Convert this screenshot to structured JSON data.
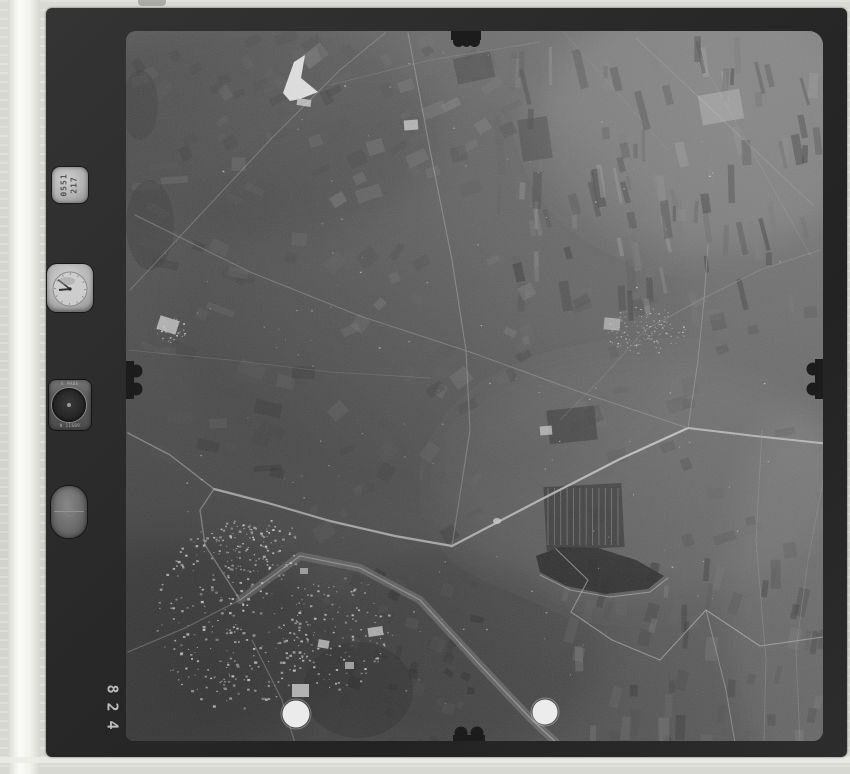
{
  "artifact": {
    "kind": "vintage aerial survey photograph, black and white film frame",
    "frame_number": "428",
    "digits_top_to_bottom": [
      "8",
      "2",
      "4"
    ]
  },
  "palette": {
    "mat": "#d6d6d0",
    "film_frame": "#2a2a2a",
    "photo_midgray": "#585858",
    "fiducial_dot": "#f2f2f2"
  },
  "instruments": {
    "id_plate": {
      "line1": "0551",
      "line2": "217"
    },
    "altimeter": {
      "label_top": "E MADE",
      "label_bottom": "N 11609"
    }
  },
  "photo": {
    "tones": [
      [
        250,
        130,
        190,
        110,
        "#000000",
        0.1
      ],
      [
        710,
        120,
        170,
        130,
        "#ffffff",
        0.1
      ],
      [
        180,
        650,
        160,
        110,
        "#000000",
        0.14
      ],
      [
        460,
        650,
        140,
        100,
        "#000000",
        0.1
      ],
      [
        800,
        600,
        70,
        190,
        "#ffffff",
        0.07
      ],
      [
        430,
        300,
        260,
        200,
        "#000000",
        0.05
      ],
      [
        640,
        480,
        200,
        120,
        "#ffffff",
        0.05
      ]
    ],
    "field_clusters": [
      {
        "seed": 11,
        "x": 490,
        "y": 36,
        "w": 325,
        "h": 264,
        "n": 110,
        "sw": [
          3,
          10
        ],
        "sh": [
          12,
          40
        ],
        "angle": -6,
        "jit": 10,
        "shade": [
          45,
          150
        ],
        "op": 0.5
      },
      {
        "seed": 22,
        "x": 300,
        "y": 36,
        "w": 200,
        "h": 170,
        "n": 40,
        "sw": [
          8,
          26
        ],
        "sh": [
          6,
          16
        ],
        "angle": -25,
        "jit": 14,
        "shade": [
          60,
          140
        ],
        "op": 0.4
      },
      {
        "seed": 33,
        "x": 128,
        "y": 150,
        "w": 172,
        "h": 320,
        "n": 45,
        "sw": [
          10,
          30
        ],
        "sh": [
          5,
          14
        ],
        "angle": 12,
        "jit": 16,
        "shade": [
          50,
          120
        ],
        "op": 0.35
      },
      {
        "seed": 44,
        "x": 300,
        "y": 240,
        "w": 260,
        "h": 300,
        "n": 55,
        "sw": [
          6,
          20
        ],
        "sh": [
          5,
          16
        ],
        "angle": -40,
        "jit": 25,
        "shade": [
          55,
          130
        ],
        "op": 0.35
      },
      {
        "seed": 55,
        "x": 560,
        "y": 555,
        "w": 260,
        "h": 183,
        "n": 60,
        "sw": [
          4,
          12
        ],
        "sh": [
          10,
          30
        ],
        "angle": 8,
        "jit": 10,
        "shade": [
          50,
          135
        ],
        "op": 0.4
      },
      {
        "seed": 66,
        "x": 560,
        "y": 300,
        "w": 260,
        "h": 260,
        "n": 40,
        "sw": [
          8,
          24
        ],
        "sh": [
          6,
          18
        ],
        "angle": -15,
        "jit": 14,
        "shade": [
          55,
          120
        ],
        "op": 0.3
      },
      {
        "seed": 77,
        "x": 300,
        "y": 560,
        "w": 180,
        "h": 180,
        "n": 50,
        "sw": [
          5,
          14
        ],
        "sh": [
          5,
          14
        ],
        "angle": 20,
        "jit": 18,
        "shade": [
          40,
          100
        ],
        "op": 0.4
      },
      {
        "seed": 88,
        "x": 128,
        "y": 36,
        "w": 172,
        "h": 114,
        "n": 30,
        "sw": [
          8,
          22
        ],
        "sh": [
          6,
          14
        ],
        "angle": -30,
        "jit": 14,
        "shade": [
          55,
          115
        ],
        "op": 0.3
      }
    ],
    "rows": [
      {
        "x": 548,
        "y": 488,
        "w": 70,
        "h": 57,
        "n": 12,
        "color": "#8f8f8f",
        "op": 0.7
      }
    ],
    "dark_patches": [
      {
        "type": "rect",
        "x": 545,
        "y": 485,
        "w": 78,
        "h": 64,
        "fill": "#3b3b3b",
        "op": 0.85,
        "rot": -3
      },
      {
        "type": "poly",
        "pts": [
          [
            536,
            556
          ],
          [
            560,
            547
          ],
          [
            598,
            548
          ],
          [
            636,
            560
          ],
          [
            664,
            576
          ],
          [
            648,
            589
          ],
          [
            606,
            594
          ],
          [
            566,
            586
          ],
          [
            540,
            572
          ]
        ],
        "fill": "#2c2c2c",
        "op": 0.92
      },
      {
        "type": "ellipse",
        "cx": 150,
        "cy": 225,
        "rx": 24,
        "ry": 45,
        "fill": "#3f3f3f",
        "op": 0.5
      },
      {
        "type": "ellipse",
        "cx": 140,
        "cy": 105,
        "rx": 18,
        "ry": 35,
        "fill": "#424242",
        "op": 0.5
      },
      {
        "type": "rect",
        "x": 548,
        "y": 408,
        "w": 48,
        "h": 34,
        "fill": "#3a3a3a",
        "op": 0.7,
        "rot": -6
      },
      {
        "type": "rect",
        "x": 455,
        "y": 55,
        "w": 38,
        "h": 26,
        "fill": "#3e3e3e",
        "op": 0.55,
        "rot": -12
      },
      {
        "type": "rect",
        "x": 520,
        "y": 118,
        "w": 30,
        "h": 42,
        "fill": "#3c3c3c",
        "op": 0.5,
        "rot": -8
      },
      {
        "type": "ellipse",
        "cx": 358,
        "cy": 690,
        "rx": 55,
        "ry": 48,
        "fill": "#383838",
        "op": 0.45
      }
    ],
    "bright_patches": [
      {
        "type": "poly",
        "pts": [
          [
            283,
            93
          ],
          [
            294,
            62
          ],
          [
            305,
            55
          ],
          [
            301,
            78
          ],
          [
            318,
            92
          ],
          [
            300,
            99
          ],
          [
            290,
            101
          ]
        ],
        "fill": "#e6e6e6",
        "op": 0.95
      },
      {
        "type": "rect",
        "x": 297,
        "y": 99,
        "w": 14,
        "h": 7,
        "fill": "#cfcfcf",
        "op": 0.8,
        "rot": 8
      },
      {
        "type": "rect",
        "x": 292,
        "y": 684,
        "w": 17,
        "h": 13,
        "fill": "#e8e8e8",
        "op": 0.9,
        "rot": 0
      },
      {
        "type": "rect",
        "x": 318,
        "y": 640,
        "w": 11,
        "h": 8,
        "fill": "#e2e2e2",
        "op": 0.85,
        "rot": 10
      },
      {
        "type": "rect",
        "x": 368,
        "y": 627,
        "w": 15,
        "h": 9,
        "fill": "#dcdcdc",
        "op": 0.85,
        "rot": -8
      },
      {
        "type": "rect",
        "x": 345,
        "y": 662,
        "w": 9,
        "h": 7,
        "fill": "#d8d8d8",
        "op": 0.8,
        "rot": 0
      },
      {
        "type": "rect",
        "x": 300,
        "y": 568,
        "w": 8,
        "h": 6,
        "fill": "#d2d2d2",
        "op": 0.8,
        "rot": 0
      },
      {
        "type": "rect",
        "x": 540,
        "y": 426,
        "w": 12,
        "h": 9,
        "fill": "#c8c8c8",
        "op": 0.8,
        "rot": -5
      },
      {
        "type": "ellipse",
        "cx": 497,
        "cy": 521,
        "rx": 4,
        "ry": 3,
        "fill": "#d8d8d8",
        "op": 0.85
      },
      {
        "type": "rect",
        "x": 158,
        "y": 318,
        "w": 20,
        "h": 14,
        "fill": "#d0d0d0",
        "op": 0.85,
        "rot": 18
      },
      {
        "type": "rect",
        "x": 404,
        "y": 120,
        "w": 14,
        "h": 10,
        "fill": "#c8c8c8",
        "op": 0.8,
        "rot": -4
      },
      {
        "type": "rect",
        "x": 700,
        "y": 92,
        "w": 42,
        "h": 30,
        "fill": "#9e9e9e",
        "op": 0.7,
        "rot": -10
      },
      {
        "type": "rect",
        "x": 604,
        "y": 318,
        "w": 16,
        "h": 12,
        "fill": "#bdbdbd",
        "op": 0.7,
        "rot": 5
      }
    ],
    "roads": [
      {
        "pts": [
          [
            214,
            489
          ],
          [
            268,
            503
          ],
          [
            330,
            521
          ],
          [
            395,
            536
          ],
          [
            452,
            546
          ]
        ],
        "w": 2.2,
        "c": "#c6c6c6",
        "op": 0.9
      },
      {
        "pts": [
          [
            452,
            546
          ],
          [
            540,
            500
          ],
          [
            620,
            459
          ],
          [
            688,
            428
          ]
        ],
        "w": 2.2,
        "c": "#c6c6c6",
        "op": 0.9
      },
      {
        "pts": [
          [
            688,
            428
          ],
          [
            755,
            436
          ],
          [
            830,
            444
          ]
        ],
        "w": 2.0,
        "c": "#c0c0c0",
        "op": 0.85
      },
      {
        "pts": [
          [
            688,
            428
          ],
          [
            698,
            360
          ],
          [
            704,
            300
          ],
          [
            708,
            245
          ]
        ],
        "w": 1.0,
        "c": "#9a9a9a",
        "op": 0.6
      },
      {
        "pts": [
          [
            130,
            290
          ],
          [
            200,
            215
          ],
          [
            270,
            140
          ],
          [
            340,
            70
          ],
          [
            385,
            33
          ]
        ],
        "w": 1.0,
        "c": "#989898",
        "op": 0.55
      },
      {
        "pts": [
          [
            408,
            33
          ],
          [
            430,
            150
          ],
          [
            452,
            260
          ],
          [
            466,
            350
          ],
          [
            470,
            430
          ],
          [
            452,
            546
          ]
        ],
        "w": 1.1,
        "c": "#9c9c9c",
        "op": 0.6
      },
      {
        "pts": [
          [
            128,
            433
          ],
          [
            170,
            455
          ],
          [
            214,
            489
          ]
        ],
        "w": 1.4,
        "c": "#b0b0b0",
        "op": 0.7
      },
      {
        "pts": [
          [
            240,
            600
          ],
          [
            300,
            556
          ],
          [
            360,
            568
          ],
          [
            420,
            600
          ],
          [
            480,
            665
          ],
          [
            532,
            720
          ],
          [
            575,
            760
          ]
        ],
        "w": 8,
        "c": "#8a8a8a",
        "op": 0.55
      },
      {
        "pts": [
          [
            240,
            600
          ],
          [
            300,
            556
          ],
          [
            360,
            568
          ],
          [
            420,
            600
          ],
          [
            480,
            665
          ],
          [
            532,
            720
          ],
          [
            575,
            760
          ]
        ],
        "w": 1.2,
        "c": "#b4b4b4",
        "op": 0.8
      },
      {
        "pts": [
          [
            240,
            600
          ],
          [
            205,
            545
          ],
          [
            200,
            510
          ],
          [
            214,
            489
          ]
        ],
        "w": 1.4,
        "c": "#aaaaaa",
        "op": 0.7
      },
      {
        "pts": [
          [
            240,
            600
          ],
          [
            185,
            628
          ],
          [
            128,
            652
          ]
        ],
        "w": 1.2,
        "c": "#a0a0a0",
        "op": 0.6
      },
      {
        "pts": [
          [
            252,
            640
          ],
          [
            282,
            700
          ],
          [
            300,
            760
          ]
        ],
        "w": 1.2,
        "c": "#a0a0a0",
        "op": 0.6
      },
      {
        "pts": [
          [
            556,
            549
          ],
          [
            588,
            580
          ],
          [
            571,
            612
          ],
          [
            612,
            640
          ],
          [
            660,
            660
          ],
          [
            706,
            610
          ],
          [
            760,
            646
          ],
          [
            830,
            636
          ]
        ],
        "w": 1.1,
        "c": "#b2b2b2",
        "op": 0.7
      },
      {
        "pts": [
          [
            706,
            610
          ],
          [
            726,
            690
          ],
          [
            738,
            760
          ]
        ],
        "w": 1.0,
        "c": "#a8a8a8",
        "op": 0.6
      },
      {
        "pts": [
          [
            762,
            430
          ],
          [
            756,
            540
          ],
          [
            766,
            660
          ],
          [
            764,
            741
          ]
        ],
        "w": 0.9,
        "c": "#949494",
        "op": 0.5
      },
      {
        "pts": [
          [
            830,
            444
          ],
          [
            808,
            560
          ],
          [
            796,
            650
          ],
          [
            800,
            741
          ]
        ],
        "w": 0.9,
        "c": "#949494",
        "op": 0.45
      },
      {
        "pts": [
          [
            135,
            215
          ],
          [
            250,
            272
          ],
          [
            360,
            316
          ],
          [
            470,
            352
          ],
          [
            580,
            392
          ],
          [
            688,
            428
          ]
        ],
        "w": 1.1,
        "c": "#959595",
        "op": 0.6
      },
      {
        "pts": [
          [
            128,
            350
          ],
          [
            230,
            360
          ],
          [
            330,
            372
          ],
          [
            430,
            378
          ]
        ],
        "w": 0.8,
        "c": "#8e8e8e",
        "op": 0.4
      },
      {
        "pts": [
          [
            330,
            85
          ],
          [
            430,
            60
          ],
          [
            540,
            42
          ]
        ],
        "w": 0.8,
        "c": "#909090",
        "op": 0.4
      },
      {
        "pts": [
          [
            645,
            330
          ],
          [
            700,
            300
          ],
          [
            760,
            270
          ],
          [
            820,
            250
          ]
        ],
        "w": 0.9,
        "c": "#949494",
        "op": 0.5
      },
      {
        "pts": [
          [
            645,
            330
          ],
          [
            600,
            380
          ],
          [
            560,
            420
          ]
        ],
        "w": 0.8,
        "c": "#909090",
        "op": 0.4
      },
      {
        "pts": [
          [
            540,
            575
          ],
          [
            570,
            590
          ],
          [
            610,
            597
          ],
          [
            650,
            592
          ],
          [
            668,
            578
          ]
        ],
        "w": 1.0,
        "c": "#b5b5b5",
        "op": 0.7
      }
    ],
    "speckles": [
      {
        "seed": 101,
        "cx": 235,
        "cy": 615,
        "rx": 80,
        "ry": 95,
        "n": 300,
        "size": [
          1,
          3
        ],
        "shade": [
          150,
          255
        ]
      },
      {
        "seed": 102,
        "cx": 255,
        "cy": 545,
        "rx": 45,
        "ry": 30,
        "n": 80,
        "size": [
          1,
          2.5
        ],
        "shade": [
          150,
          245
        ]
      },
      {
        "seed": 103,
        "cx": 340,
        "cy": 630,
        "rx": 50,
        "ry": 60,
        "n": 120,
        "size": [
          1,
          2.5
        ],
        "shade": [
          140,
          240
        ]
      },
      {
        "seed": 104,
        "cx": 645,
        "cy": 330,
        "rx": 40,
        "ry": 24,
        "n": 130,
        "size": [
          0.8,
          1.8
        ],
        "shade": [
          120,
          200
        ]
      },
      {
        "seed": 105,
        "cx": 170,
        "cy": 330,
        "rx": 16,
        "ry": 12,
        "n": 30,
        "size": [
          1,
          2
        ],
        "shade": [
          140,
          230
        ]
      },
      {
        "seed": 106,
        "cx": 475,
        "cy": 380,
        "rx": 340,
        "ry": 330,
        "n": 130,
        "size": [
          0.8,
          1.8
        ],
        "shade": [
          120,
          200
        ]
      }
    ],
    "scratches": [
      {
        "pts": [
          [
            636,
            38
          ],
          [
            814,
            206
          ]
        ],
        "op": 0.18
      },
      {
        "pts": [
          [
            700,
            58
          ],
          [
            812,
            258
          ]
        ],
        "op": 0.1
      },
      {
        "pts": [
          [
            560,
            28
          ],
          [
            668,
            150
          ]
        ],
        "op": 0.08
      }
    ],
    "notches": {
      "fill": "#1c1c1c",
      "rects": [
        [
          451,
          31,
          30,
          9
        ],
        [
          453,
          735,
          32,
          7
        ],
        [
          126,
          361,
          8,
          38
        ],
        [
          815,
          359,
          9,
          40
        ]
      ],
      "circles": [
        [
          458.5,
          41.5,
          5.5
        ],
        [
          466.5,
          42,
          5
        ],
        [
          474.5,
          41.5,
          5.5
        ],
        [
          461,
          733,
          6.5
        ],
        [
          477,
          733,
          6.5
        ],
        [
          136,
          371,
          6.5
        ],
        [
          136,
          389,
          6.5
        ],
        [
          813,
          369,
          6.5
        ],
        [
          813,
          389,
          6.5
        ]
      ]
    },
    "fiducial_dots": [
      [
        296,
        714,
        13.5
      ],
      [
        545,
        712,
        12.5
      ]
    ]
  }
}
